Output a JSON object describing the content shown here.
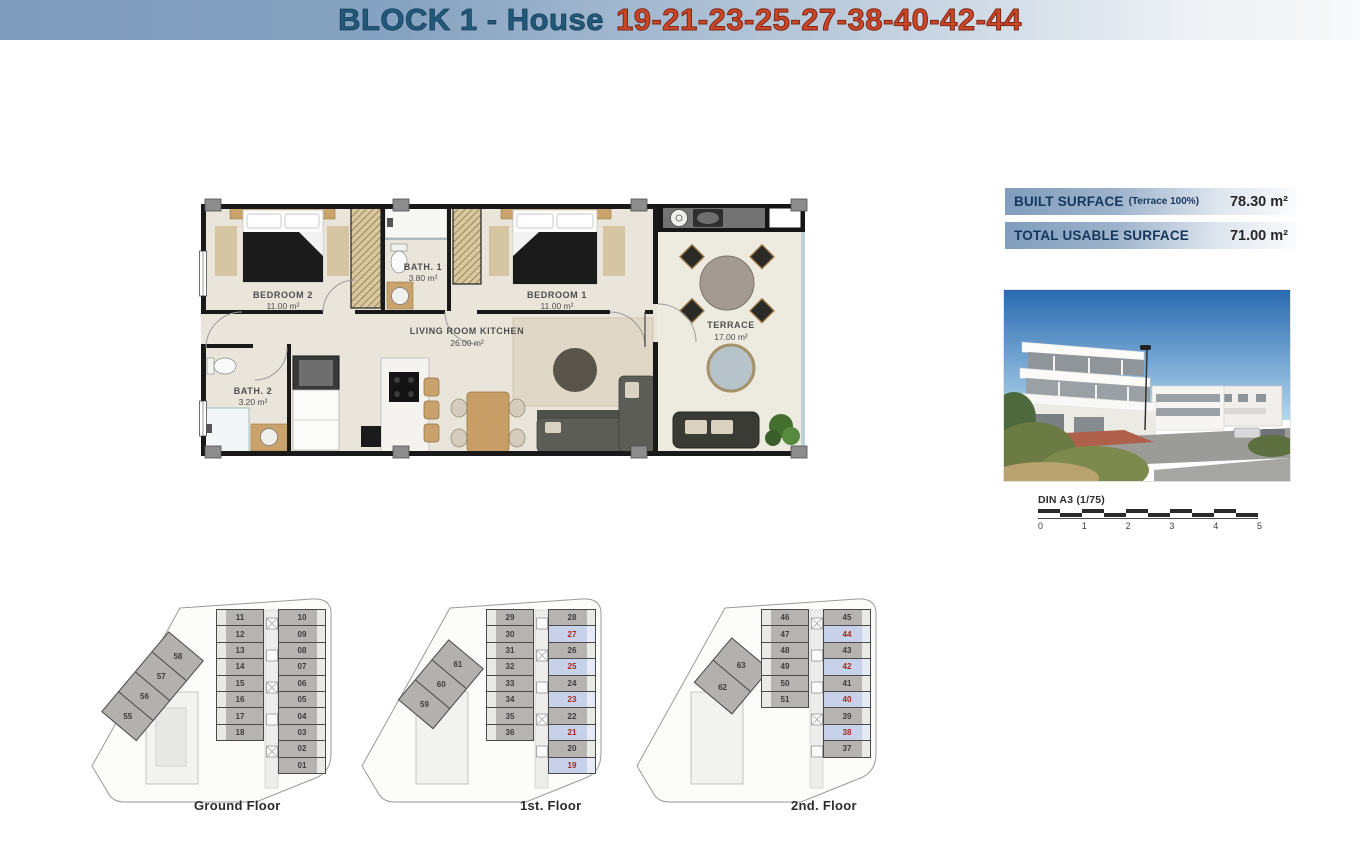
{
  "header": {
    "title_block": "BLOCK 1 - House",
    "title_numbers": "19-21-23-25-27-38-40-42-44"
  },
  "surface_table": {
    "rows": [
      {
        "label": "BUILT SURFACE",
        "note": "(Terrace 100%)",
        "value": "78.30 m²"
      },
      {
        "label": "TOTAL USABLE SURFACE",
        "note": "",
        "value": "71.00 m²"
      }
    ]
  },
  "floor_plan": {
    "rooms": {
      "bedroom2": {
        "name": "BEDROOM 2",
        "area": "11.00 m²"
      },
      "bath1": {
        "name": "BATH. 1",
        "area": "3.80 m²"
      },
      "bedroom1": {
        "name": "BEDROOM 1",
        "area": "11.00 m²"
      },
      "living": {
        "name": "LIVING ROOM KITCHEN",
        "area": "26.00 m²"
      },
      "bath2": {
        "name": "BATH. 2",
        "area": "3.20 m²"
      },
      "terrace": {
        "name": "TERRACE",
        "area": "17.00 m²"
      }
    }
  },
  "scale_bar": {
    "label": "DIN A3 (1/75)",
    "ticks": [
      "0",
      "1",
      "2",
      "3",
      "4",
      "5"
    ]
  },
  "floors": [
    {
      "label": "Ground Floor",
      "left_column": [
        "11",
        "12",
        "13",
        "14",
        "15",
        "16",
        "17",
        "18"
      ],
      "right_column": [
        "10",
        "09",
        "08",
        "07",
        "06",
        "05",
        "04",
        "03",
        "02",
        "01"
      ],
      "diagonal": [
        "58",
        "57",
        "56",
        "55"
      ],
      "highlighted": []
    },
    {
      "label": "1st. Floor",
      "left_column": [
        "29",
        "30",
        "31",
        "32",
        "33",
        "34",
        "35",
        "36"
      ],
      "right_column": [
        "28",
        "27",
        "26",
        "25",
        "24",
        "23",
        "22",
        "21",
        "20",
        "19"
      ],
      "diagonal": [
        "61",
        "60",
        "59"
      ],
      "highlighted": [
        "27",
        "25",
        "23",
        "21",
        "19"
      ]
    },
    {
      "label": "2nd. Floor",
      "left_column": [
        "46",
        "47",
        "48",
        "49",
        "50",
        "51"
      ],
      "right_column": [
        "45",
        "44",
        "43",
        "42",
        "41",
        "40",
        "39",
        "38",
        "37"
      ],
      "diagonal": [
        "63",
        "62"
      ],
      "highlighted": [
        "44",
        "42",
        "40",
        "38"
      ]
    }
  ],
  "colors": {
    "header_blue": "#7e9cbd",
    "accent_blue": "#21597a",
    "accent_red": "#cb4527",
    "unit_fill": "#b5b4b1",
    "highlight_fill": "#c7d1e9",
    "highlight_number": "#a5281e"
  }
}
